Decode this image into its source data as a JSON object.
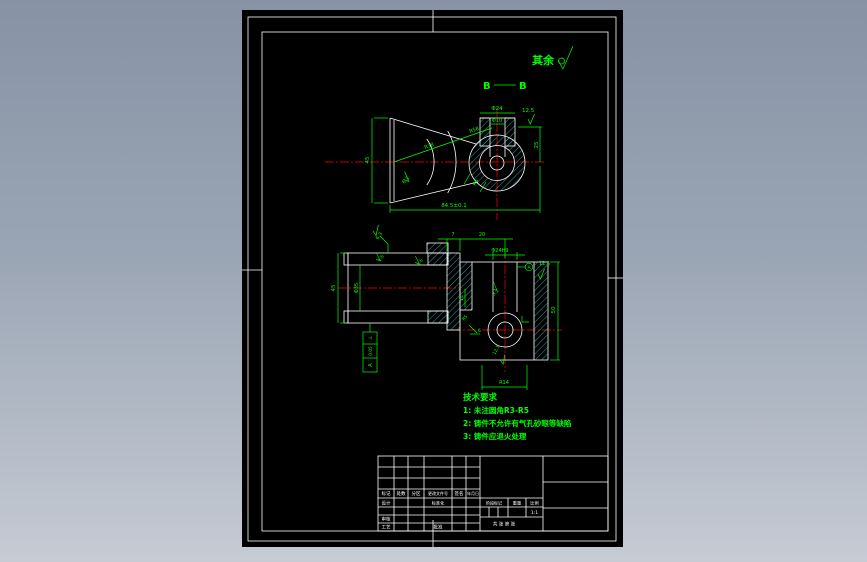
{
  "palette": {
    "background_top": "#8793a5",
    "background_bottom": "#c6cbd4",
    "line": "#ffffff",
    "dim": "#00ff00",
    "centerline": "#ff0000",
    "hatch": "#45d8d8"
  },
  "annotations": {
    "surplus": "其余",
    "section_left": "B",
    "section_right": "B"
  },
  "top_view": {
    "dia_outer": "Φ24",
    "dia_hole": "Φ10",
    "rough_top": "12.5",
    "dim_right": "25",
    "dim_left": "45",
    "dim_bottom": "84.5±0.1",
    "radius_outer": "R58",
    "radius_inner": "R38",
    "rough_face": "6.3",
    "radius_rib": "R6"
  },
  "section_view": {
    "rough_top_left": "6.3",
    "dim_left": "45",
    "dia_bore": "Φ35",
    "rough_bore_top": "1.6",
    "rough_bore_right": "1.6",
    "dim_wall": "7",
    "dim_offset": "20",
    "dia_boss": "Φ24H9",
    "datum": "A",
    "rough_top_right": "12.5",
    "dim_right": "50",
    "dim_notch": "14",
    "radius_corner": "R5",
    "dim_step": "6",
    "rough_hole": "3.2",
    "rough_bottom": "12.5",
    "dim_bottom": "R14",
    "gdt_symbol": "⊥",
    "gdt_value": "0.05",
    "gdt_datum": "A"
  },
  "tech_requirements": {
    "title": "技术要求",
    "items": [
      "1: 未注圆角R3-R5",
      "2: 铸件不允许有气孔砂眼等缺陷",
      "3: 铸件应退火处理"
    ]
  },
  "title_block": {
    "rev_headers": [
      "标记",
      "处数",
      "分区",
      "更改文件号",
      "签名",
      "年月日"
    ],
    "design": "设计",
    "standardization": "标准化",
    "audit": "审核",
    "process": "工艺",
    "approve": "批准",
    "stage_label": "阶段标记",
    "weight_label": "重量",
    "scale_label": "比例",
    "scale_value": "1:1",
    "sheets": "共 张 第 张"
  }
}
